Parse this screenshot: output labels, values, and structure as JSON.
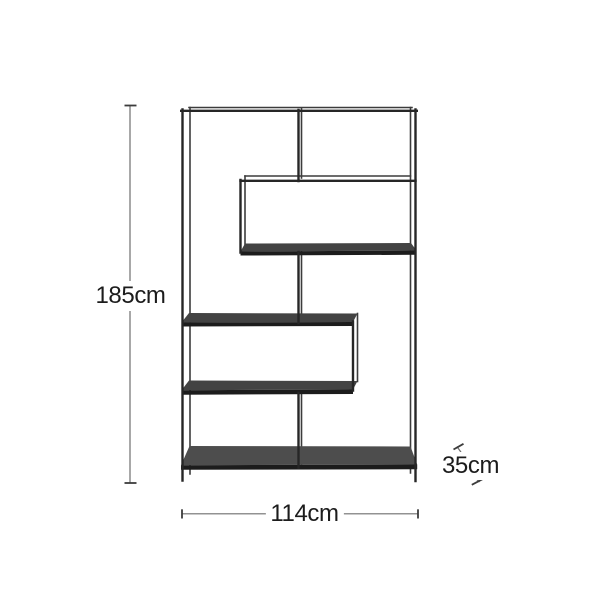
{
  "diagram": {
    "type": "furniture-dimension-diagram",
    "subject": "open metal-frame shelving unit with staggered box shelves",
    "dimensions": {
      "height": "185cm",
      "width": "114cm",
      "depth": "35cm"
    },
    "colors": {
      "background": "#ffffff",
      "frame_front": "#262626",
      "frame_back": "#3c3c3c",
      "shelf_fill": "#434343",
      "shelf_fill_light": "#4d4d4d",
      "shelf_edge": "#1c1c1c",
      "dimension_line": "#6f6f6f",
      "dimension_cap": "#3c3c3c",
      "label_text": "#1c1c1c"
    }
  }
}
